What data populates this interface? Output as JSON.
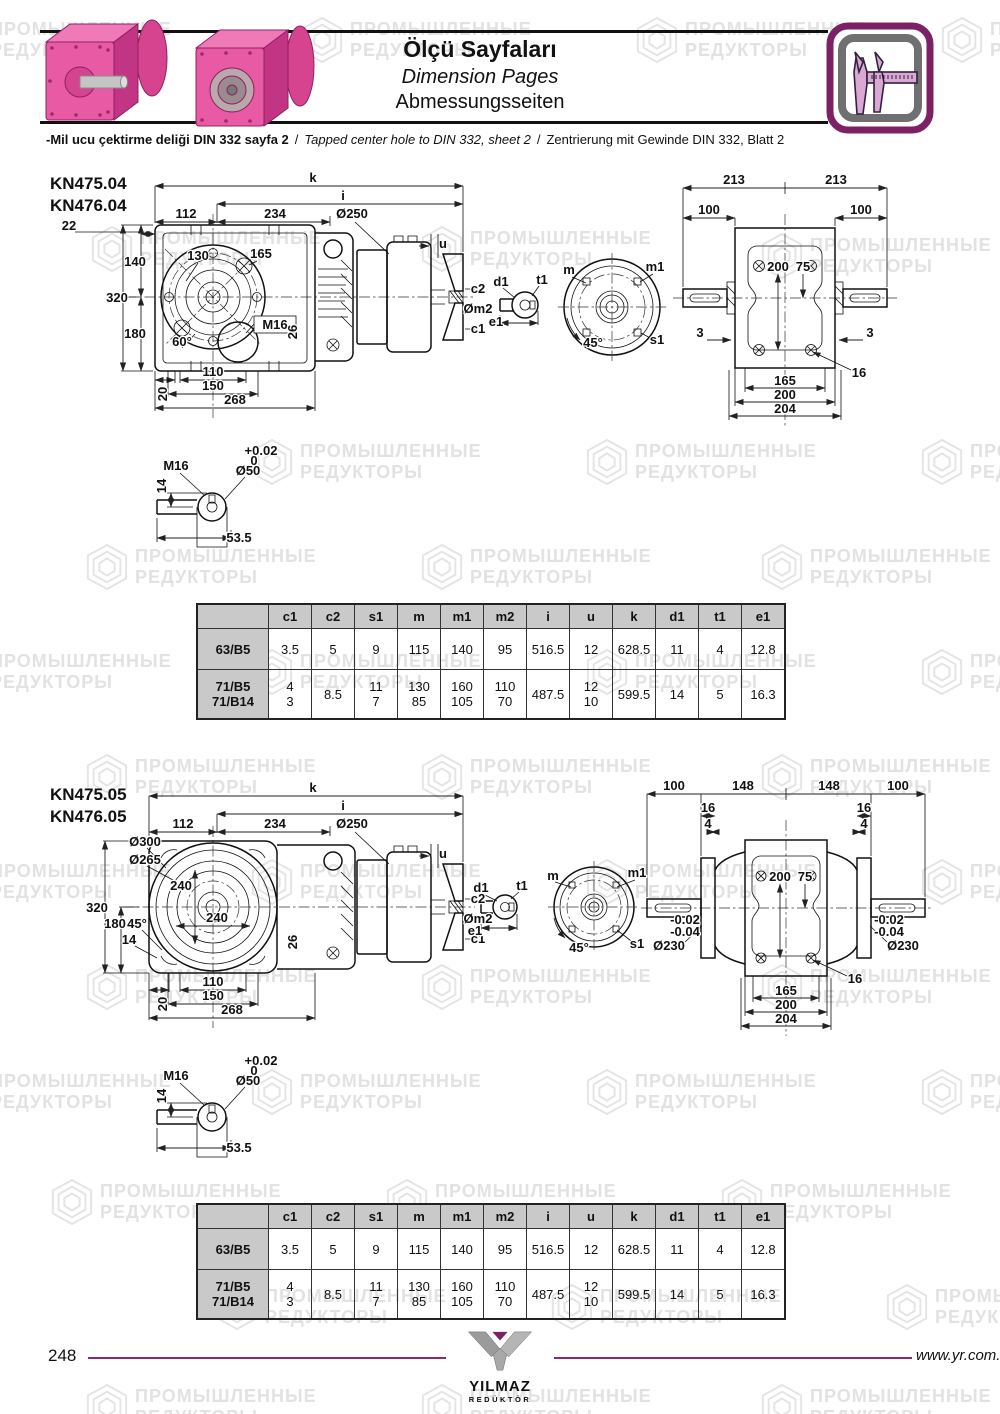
{
  "header": {
    "title_tr": "Ölçü Sayfaları",
    "title_en": "Dimension Pages",
    "title_de": "Abmessungsseiten",
    "note_tr": "-Mil ucu çektirme deliği DIN 332 sayfa 2",
    "note_sep": "/",
    "note_en": "Tapped center hole to DIN 332, sheet 2",
    "note_de": "Zentrierung mit Gewinde DIN 332, Blatt 2",
    "accent_color": "#7c2166"
  },
  "watermark": {
    "line1": "ПРОМЫШЛЕННЫЕ",
    "line2": "РЕДУКТОРЫ",
    "color": "#e4e4e4",
    "positions": [
      [
        -60,
        16
      ],
      [
        300,
        16
      ],
      [
        635,
        16
      ],
      [
        940,
        16
      ],
      [
        90,
        225
      ],
      [
        420,
        225
      ],
      [
        760,
        232
      ],
      [
        250,
        438
      ],
      [
        585,
        438
      ],
      [
        920,
        438
      ],
      [
        85,
        543
      ],
      [
        420,
        543
      ],
      [
        760,
        543
      ],
      [
        -60,
        648
      ],
      [
        250,
        648
      ],
      [
        585,
        648
      ],
      [
        920,
        648
      ],
      [
        85,
        753
      ],
      [
        420,
        753
      ],
      [
        760,
        753
      ],
      [
        -60,
        858
      ],
      [
        250,
        858
      ],
      [
        585,
        858
      ],
      [
        920,
        858
      ],
      [
        85,
        963
      ],
      [
        420,
        963
      ],
      [
        760,
        963
      ],
      [
        -60,
        1068
      ],
      [
        250,
        1068
      ],
      [
        585,
        1068
      ],
      [
        920,
        1068
      ],
      [
        50,
        1178
      ],
      [
        385,
        1178
      ],
      [
        720,
        1178
      ],
      [
        215,
        1283
      ],
      [
        550,
        1283
      ],
      [
        885,
        1283
      ],
      [
        85,
        1383
      ],
      [
        420,
        1383
      ],
      [
        760,
        1383
      ]
    ]
  },
  "sections": [
    {
      "model1": "KN475.04",
      "model2": "KN476.04",
      "labels": [
        {
          "t": "k",
          "x": 268,
          "y": 12
        },
        {
          "t": "i",
          "x": 298,
          "y": 30
        },
        {
          "t": "112",
          "x": 141,
          "y": 48
        },
        {
          "t": "234",
          "x": 230,
          "y": 48
        },
        {
          "t": "Ø250",
          "x": 307,
          "y": 48
        },
        {
          "t": "22",
          "x": 24,
          "y": 60
        },
        {
          "t": "140",
          "x": 90,
          "y": 96,
          "a": "end"
        },
        {
          "t": "320",
          "x": 72,
          "y": 132,
          "a": "end"
        },
        {
          "t": "180",
          "x": 90,
          "y": 168,
          "a": "end"
        },
        {
          "t": "130",
          "x": 153,
          "y": 90
        },
        {
          "t": "165",
          "x": 216,
          "y": 88
        },
        {
          "t": "60°",
          "x": 137,
          "y": 176
        },
        {
          "t": "M16",
          "x": 230,
          "y": 159
        },
        {
          "t": "26",
          "x": 252,
          "y": 162,
          "r": -90
        },
        {
          "t": "20",
          "x": 122,
          "y": 224,
          "r": -90
        },
        {
          "t": "110",
          "x": 168,
          "y": 206
        },
        {
          "t": "150",
          "x": 168,
          "y": 220
        },
        {
          "t": "268",
          "x": 190,
          "y": 234
        },
        {
          "t": "u",
          "x": 398,
          "y": 78,
          "a": "start"
        },
        {
          "t": "c2",
          "x": 433,
          "y": 123,
          "a": "start"
        },
        {
          "t": "Øm2",
          "x": 433,
          "y": 143,
          "a": "start"
        },
        {
          "t": "c1",
          "x": 433,
          "y": 163,
          "a": "start"
        },
        {
          "t": "d1",
          "x": 456,
          "y": 116,
          "a": "end"
        },
        {
          "t": "t1",
          "x": 497,
          "y": 114
        },
        {
          "t": "e1",
          "x": 451,
          "y": 156,
          "a": "end"
        },
        {
          "t": "m",
          "x": 524,
          "y": 104,
          "a": "end"
        },
        {
          "t": "m1",
          "x": 610,
          "y": 101
        },
        {
          "t": "45°",
          "x": 548,
          "y": 177
        },
        {
          "t": "s1",
          "x": 612,
          "y": 174
        },
        {
          "t": "213",
          "x": 689,
          "y": 14
        },
        {
          "t": "213",
          "x": 791,
          "y": 14
        },
        {
          "t": "100",
          "x": 664,
          "y": 44
        },
        {
          "t": "100",
          "x": 816,
          "y": 44
        },
        {
          "t": "200",
          "x": 733,
          "y": 101
        },
        {
          "t": "75",
          "x": 758,
          "y": 101
        },
        {
          "t": "3",
          "x": 655,
          "y": 167
        },
        {
          "t": "3",
          "x": 825,
          "y": 167
        },
        {
          "t": "165",
          "x": 740,
          "y": 215
        },
        {
          "t": "200",
          "x": 740,
          "y": 229
        },
        {
          "t": "204",
          "x": 740,
          "y": 243
        },
        {
          "t": "16",
          "x": 814,
          "y": 207
        },
        {
          "t": "M16",
          "x": 131,
          "y": 300
        },
        {
          "t": "+0.02",
          "x": 216,
          "y": 285,
          "s": 10
        },
        {
          "t": "0",
          "x": 209,
          "y": 295,
          "s": 10
        },
        {
          "t": "Ø50",
          "x": 203,
          "y": 305
        },
        {
          "t": "14",
          "x": 121,
          "y": 316,
          "r": -90
        },
        {
          "t": "53.5",
          "x": 194,
          "y": 372,
          "a": "start"
        }
      ]
    },
    {
      "model1": "KN475.05",
      "model2": "KN476.05",
      "labels": [
        {
          "t": "k",
          "x": 268,
          "y": 12
        },
        {
          "t": "i",
          "x": 298,
          "y": 30
        },
        {
          "t": "112",
          "x": 138,
          "y": 48
        },
        {
          "t": "234",
          "x": 230,
          "y": 48
        },
        {
          "t": "Ø250",
          "x": 307,
          "y": 48
        },
        {
          "t": "Ø300",
          "x": 100,
          "y": 66,
          "a": "end"
        },
        {
          "t": "Ø265",
          "x": 100,
          "y": 84,
          "a": "end"
        },
        {
          "t": "240",
          "x": 136,
          "y": 110
        },
        {
          "t": "240",
          "x": 172,
          "y": 142
        },
        {
          "t": "320",
          "x": 52,
          "y": 132,
          "a": "end"
        },
        {
          "t": "180",
          "x": 70,
          "y": 148,
          "a": "end"
        },
        {
          "t": "45°",
          "x": 92,
          "y": 148
        },
        {
          "t": "14",
          "x": 84,
          "y": 164
        },
        {
          "t": "26",
          "x": 252,
          "y": 162,
          "r": -90
        },
        {
          "t": "20",
          "x": 122,
          "y": 224,
          "r": -90
        },
        {
          "t": "110",
          "x": 168,
          "y": 206
        },
        {
          "t": "150",
          "x": 168,
          "y": 220
        },
        {
          "t": "268",
          "x": 187,
          "y": 234
        },
        {
          "t": "u",
          "x": 398,
          "y": 78,
          "a": "start"
        },
        {
          "t": "c2",
          "x": 433,
          "y": 123,
          "a": "start"
        },
        {
          "t": "Øm2",
          "x": 433,
          "y": 143,
          "a": "start"
        },
        {
          "t": "c1",
          "x": 433,
          "y": 163,
          "a": "start"
        },
        {
          "t": "d1",
          "x": 436,
          "y": 112,
          "a": "end"
        },
        {
          "t": "t1",
          "x": 477,
          "y": 110
        },
        {
          "t": "e1",
          "x": 430,
          "y": 155,
          "a": "end"
        },
        {
          "t": "m",
          "x": 508,
          "y": 100,
          "a": "end"
        },
        {
          "t": "m1",
          "x": 592,
          "y": 97
        },
        {
          "t": "45°",
          "x": 534,
          "y": 172
        },
        {
          "t": "s1",
          "x": 592,
          "y": 168
        },
        {
          "t": "100",
          "x": 629,
          "y": 10
        },
        {
          "t": "148",
          "x": 698,
          "y": 10
        },
        {
          "t": "148",
          "x": 784,
          "y": 10
        },
        {
          "t": "100",
          "x": 853,
          "y": 10
        },
        {
          "t": "16",
          "x": 663,
          "y": 32
        },
        {
          "t": "4",
          "x": 663,
          "y": 48
        },
        {
          "t": "16",
          "x": 819,
          "y": 32
        },
        {
          "t": "4",
          "x": 819,
          "y": 48
        },
        {
          "t": "200",
          "x": 735,
          "y": 101
        },
        {
          "t": "75",
          "x": 760,
          "y": 101
        },
        {
          "t": "-0.02",
          "x": 640,
          "y": 144,
          "s": 11
        },
        {
          "t": "-0.04",
          "x": 640,
          "y": 156,
          "s": 11
        },
        {
          "t": "Ø230",
          "x": 624,
          "y": 170
        },
        {
          "t": "-0.02",
          "x": 844,
          "y": 144,
          "s": 11
        },
        {
          "t": "-0.04",
          "x": 844,
          "y": 156,
          "s": 11
        },
        {
          "t": "Ø230",
          "x": 858,
          "y": 170
        },
        {
          "t": "165",
          "x": 741,
          "y": 215
        },
        {
          "t": "200",
          "x": 741,
          "y": 229
        },
        {
          "t": "204",
          "x": 741,
          "y": 243
        },
        {
          "t": "16",
          "x": 810,
          "y": 203
        },
        {
          "t": "M16",
          "x": 131,
          "y": 300
        },
        {
          "t": "+0.02",
          "x": 216,
          "y": 285,
          "s": 10
        },
        {
          "t": "0",
          "x": 209,
          "y": 295,
          "s": 10
        },
        {
          "t": "Ø50",
          "x": 203,
          "y": 305
        },
        {
          "t": "14",
          "x": 121,
          "y": 316,
          "r": -90
        },
        {
          "t": "53.5",
          "x": 194,
          "y": 372,
          "a": "start"
        }
      ]
    }
  ],
  "table": {
    "headers": [
      "",
      "c1",
      "c2",
      "s1",
      "m",
      "m1",
      "m2",
      "i",
      "u",
      "k",
      "d1",
      "t1",
      "e1"
    ],
    "rows": [
      {
        "label": "63/B5",
        "values": [
          "3.5",
          "5",
          "9",
          "115",
          "140",
          "95",
          "516.5",
          "12",
          "628.5",
          "11",
          "4",
          "12.8"
        ]
      },
      {
        "label": "71/B5\n71/B14",
        "values": [
          "4\n3",
          "8.5",
          "11\n7",
          "130\n85",
          "160\n105",
          "110\n70",
          "487.5",
          "12\n10",
          "599.5",
          "14",
          "5",
          "16.3"
        ]
      }
    ]
  },
  "footer": {
    "page_number": "248",
    "website": "www.yr.com.tr",
    "logo_top": "YILMAZ",
    "logo_bottom": "REDÜKTÖR",
    "line_color": "#8d2a6e"
  }
}
